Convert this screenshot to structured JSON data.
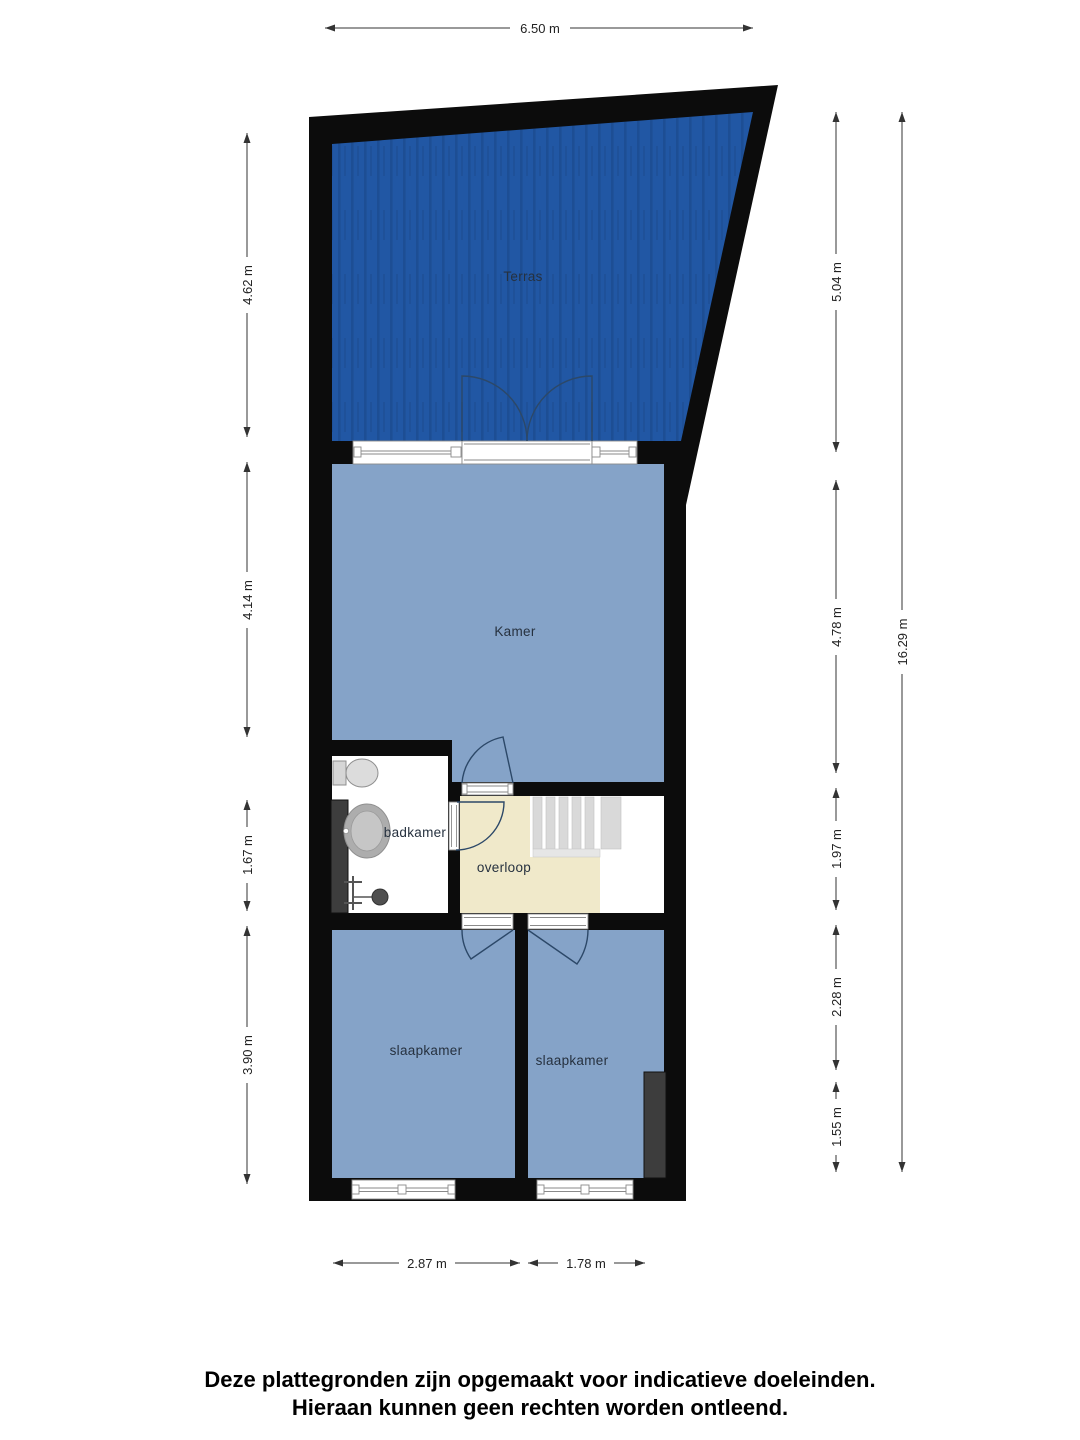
{
  "floor_plan": {
    "rooms": {
      "terras": {
        "label": "Terras"
      },
      "kamer": {
        "label": "Kamer"
      },
      "badkamer": {
        "label": "badkamer"
      },
      "overloop": {
        "label": "overloop"
      },
      "slaapkamer_left": {
        "label": "slaapkamer"
      },
      "slaapkamer_right": {
        "label": "slaapkamer"
      }
    },
    "dimensions": {
      "top_width": "6.50 m",
      "left": [
        {
          "label": "4.62 m"
        },
        {
          "label": "4.14 m"
        },
        {
          "label": "1.67 m"
        },
        {
          "label": "3.90 m"
        }
      ],
      "right": [
        {
          "label": "5.04 m"
        },
        {
          "label": "4.78 m"
        },
        {
          "label": "1.97 m"
        },
        {
          "label": "2.28 m"
        },
        {
          "label": "1.55 m"
        }
      ],
      "total_height": "16.29 m",
      "bottom": [
        {
          "label": "2.87 m"
        },
        {
          "label": "1.78 m"
        }
      ]
    },
    "colors": {
      "wall": "#0c0c0c",
      "terrace": "#2157a4",
      "room_blue": "#85a3c8",
      "landing_cream": "#f0e9ca",
      "duct_gray": "#3d3d3d"
    },
    "footer": {
      "line1": "Deze plattegronden zijn opgemaakt voor indicatieve doeleinden.",
      "line2": "Hieraan kunnen geen rechten worden ontleend."
    }
  }
}
